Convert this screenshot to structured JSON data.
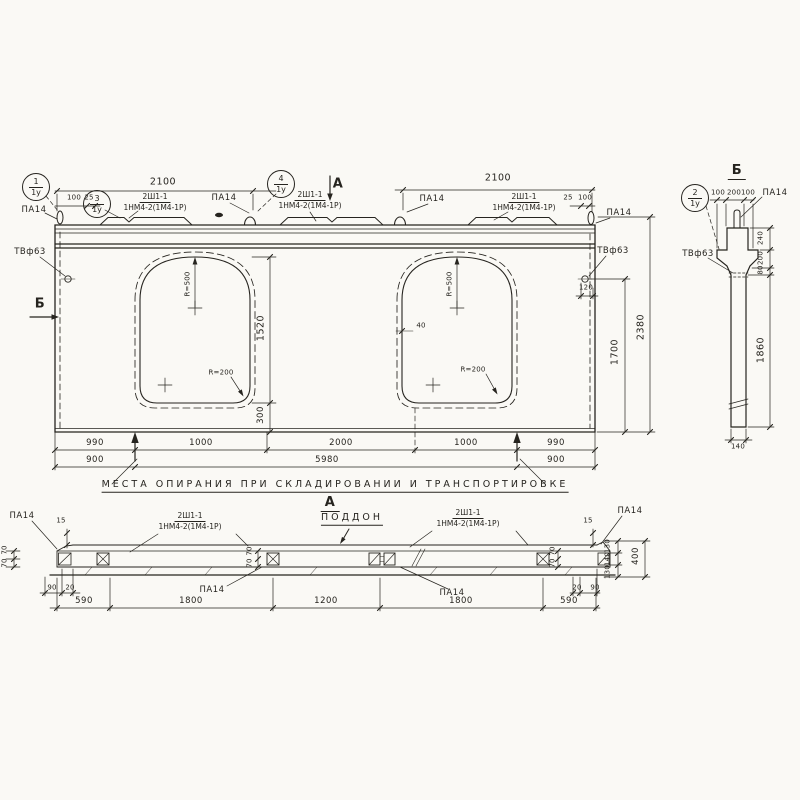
{
  "colors": {
    "paper": "#faf9f5",
    "ink": "#26241f"
  },
  "balloons": {
    "b1": {
      "num": "1",
      "den": "1у"
    },
    "b2": {
      "num": "2",
      "den": "1у"
    },
    "b3": {
      "num": "3",
      "den": "1у"
    },
    "b4": {
      "num": "4",
      "den": "1у"
    }
  },
  "labels": {
    "pa14": "ПА14",
    "tv63": "ТВф63",
    "mark_top": "2Ш1-1",
    "mark_bottom": "1НМ4-2(1М4-1Р)",
    "r500": "R=500",
    "r200": "R=200",
    "poddon": "ПОДДОН",
    "section_a": "А",
    "section_b": "Б",
    "support_note": "МЕСТА ОПИРАНИЯ ПРИ СКЛАДИРОВАНИИ И ТРАНСПОРТИРОВКЕ"
  },
  "dims": {
    "d2100": "2100",
    "d100": "100",
    "d25": "25",
    "d40": "40",
    "d120": "120",
    "d1520": "1520",
    "d300": "300",
    "d1700": "1700",
    "d2380": "2380",
    "d990": "990",
    "d1000": "1000",
    "d2000": "2000",
    "d900": "900",
    "d5980": "5980",
    "d590": "590",
    "d1800": "1800",
    "d1200": "1200",
    "d15": "15",
    "d70": "70",
    "d90": "90",
    "d20": "20",
    "d130": "130",
    "d140": "140",
    "d400": "400",
    "d240": "240",
    "d200": "200",
    "d80": "80",
    "d1860": "1860"
  }
}
